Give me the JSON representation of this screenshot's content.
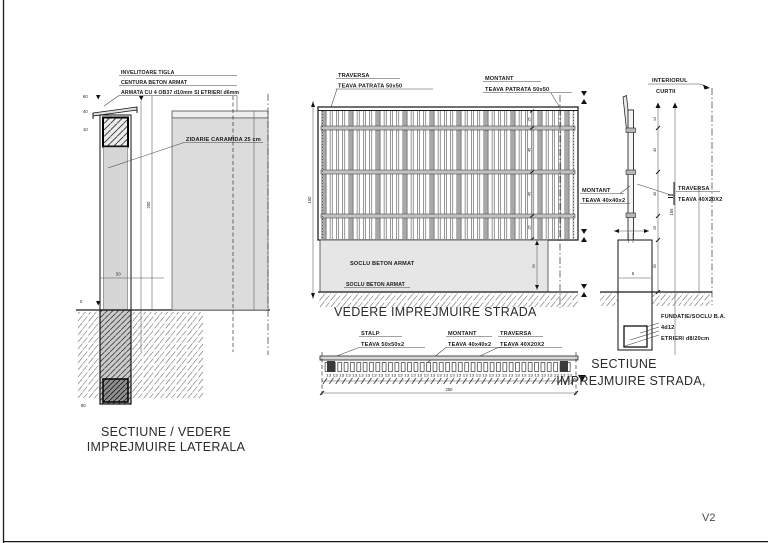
{
  "page": {
    "revision": "V2"
  },
  "colors": {
    "line": "#1a1a1a",
    "fill_gray": "#d6d6d6",
    "fill_soclu": "#e6e6e6",
    "bar_gray": "#aaaaaa"
  },
  "left_view": {
    "title_line1": "SECTIUNE / VEDERE",
    "title_line2": "IMPREJMUIRE LATERALA",
    "notes": {
      "line1": "INVELITOARE TIGLA",
      "line2": "CENTURA BETON ARMAT",
      "line3": "ARMATA CU 4 OB37 d10mm SI ETRIERI d6mm"
    },
    "wall_label": "ZIDARIE CARAMIDA 25 cm",
    "dims": {
      "d1": "60",
      "d2": "40",
      "d3": "10",
      "height": "200",
      "soclu": "50",
      "ground": "0",
      "depth": "80"
    }
  },
  "street_view": {
    "title": "VEDERE IMPREJMUIRE STRADA",
    "traversa": {
      "name": "TRAVERSA",
      "spec": "TEAVA PATRATA 50x50"
    },
    "montant": {
      "name": "MONTANT",
      "spec": "TEAVA PATRATA 50x50"
    },
    "soclu_label": "SOCLU BETON ARMAT",
    "soclu_label2": "SOCLU BETON ARMAT",
    "dims": {
      "height": "150",
      "soclu_h": "50",
      "seg1": "25",
      "seg2": "45",
      "seg3": "45",
      "seg4": "25",
      "spacing_row": "13 13 13 13 13 13 13 13 13 13 13 13 13 13 13 13 13 13 13 13 13 13 13 13 13 13 13 13 13 13 13 13 13 13 13 13 13 13",
      "overall": "250"
    }
  },
  "plan_view": {
    "stalp": {
      "name": "STALP",
      "spec": "TEAVA 50x50x2"
    },
    "montant": {
      "name": "MONTANT",
      "spec": "TEAVA 40x40x2"
    },
    "traversa": {
      "name": "TRAVERSA",
      "spec": "TEAVA 40X20X2"
    }
  },
  "street_section": {
    "title_line1": "SECTIUNE",
    "title_line2": "IMPREJMUIRE STRADA,",
    "interior_line1": "INTERIORUL",
    "interior_line2": "CURTII",
    "montant": {
      "name": "MONTANT",
      "spec": "TEAVA 40x40x2"
    },
    "traversa": {
      "name": "TRAVERSA",
      "spec": "TEAVA 40X20X2"
    },
    "foundation": {
      "line1": "FUNDATIE/SOCLU B.A.",
      "line2": "4d12",
      "line3": "ETRIERI d8/20cm"
    },
    "dims": {
      "s1": "13",
      "s2": "45",
      "s3": "45",
      "s4": "25",
      "s5": "50",
      "overall": "155",
      "soclu": "5"
    }
  }
}
